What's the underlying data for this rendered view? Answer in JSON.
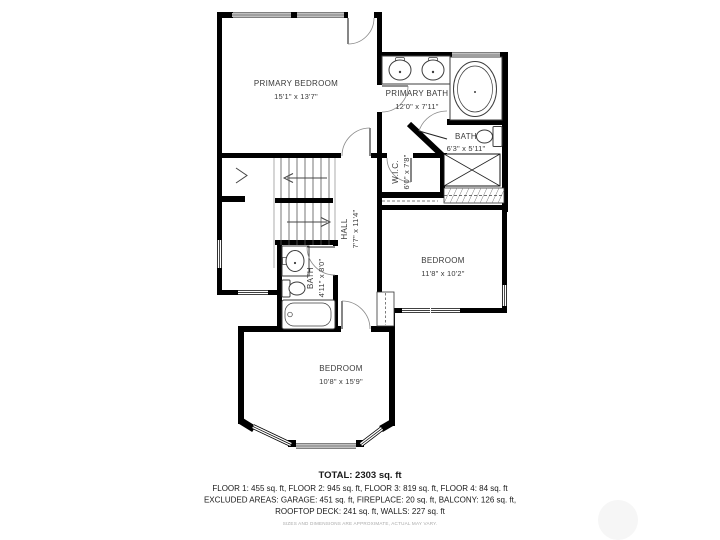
{
  "plan": {
    "type": "floorplan",
    "colors": {
      "wall": "#000000",
      "fixture": "#3d3d3d",
      "label": "#3a3a3a",
      "background": "#ffffff"
    },
    "rooms": [
      {
        "name": "PRIMARY BEDROOM",
        "dims": "15'1\" x 13'7\""
      },
      {
        "name": "PRIMARY BATH",
        "dims": "12'0\" x 7'11\""
      },
      {
        "name": "BATH",
        "dims": "6'3\" x 5'11\""
      },
      {
        "name": "W.I.C.",
        "dims": "6'0\" x 7'8\""
      },
      {
        "name": "HALL",
        "dims": "7'7\" x 11'4\""
      },
      {
        "name": "BEDROOM",
        "dims": "11'8\" x 10'2\""
      },
      {
        "name": "BATH",
        "dims": "4'11\" x 8'0\""
      },
      {
        "name": "BEDROOM",
        "dims": "10'8\" x 15'9\""
      }
    ]
  },
  "summary": {
    "total": "TOTAL: 2303 sq. ft",
    "floors": "FLOOR 1: 455 sq. ft, FLOOR 2: 945 sq. ft, FLOOR 3: 819 sq. ft, FLOOR 4: 84 sq. ft",
    "excluded_line1": "EXCLUDED AREAS: GARAGE: 451 sq. ft, FIREPLACE: 20 sq. ft, BALCONY: 126 sq. ft,",
    "excluded_line2": "ROOFTOP DECK: 241 sq. ft, WALLS: 227 sq. ft",
    "disclaimer": "SIZES AND DIMENSIONS ARE APPROXIMATE, ACTUAL MAY VARY."
  }
}
